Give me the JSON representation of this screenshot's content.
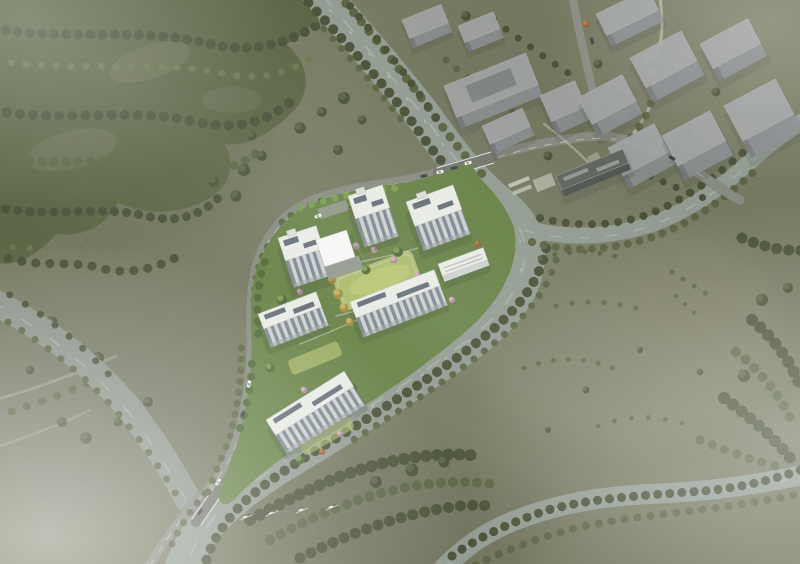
{
  "scene": {
    "kind": "aerial-architectural-rendering",
    "visible_text": "none"
  },
  "palette": {
    "terrain_base": "#72765d",
    "terrain_light": "#7e8168",
    "terrain_dark": "#62674d",
    "forest_dark": "#444c32",
    "forest_mid": "#55603e",
    "forest_light": "#67724a",
    "site_green": "#637e40",
    "site_green_dark": "#4c6431",
    "lawn": "#a9b967",
    "lawn_bright": "#bac972",
    "tree_bright": "#76984c",
    "tree_yellow": "#c3ab55",
    "tree_pink": "#cfabb9",
    "tree_orange": "#b4703f",
    "water": "#8e988e",
    "water_light": "#b2bab0",
    "water_west": "#879086",
    "road": "#84887c",
    "road_dark": "#6e7267",
    "path_light": "#b3b5a6",
    "roof_white": "#e9ebe6",
    "facade": "#cbd0cf",
    "window": "#79848e",
    "panel_dark": "#49545f",
    "canopy": "#f6f7f4",
    "plaza": "#90958b",
    "grey_top": "#9da0a1",
    "grey_side": "#84888b",
    "grey_dark": "#6f7478",
    "car_white": "#f3f4f1",
    "car_dark": "#3f4448",
    "fog": "#ffffff",
    "shadow": "#2f3a28"
  }
}
